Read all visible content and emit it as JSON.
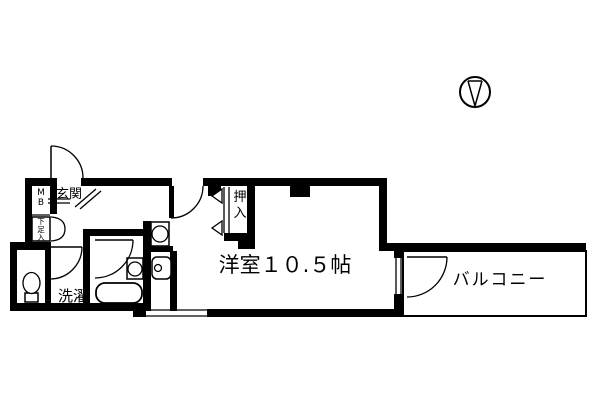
{
  "canvas": {
    "width": 600,
    "height": 400,
    "background": "#ffffff",
    "ink": "#000000"
  },
  "labels": {
    "genkan": "玄関",
    "mb": "MB",
    "shoebox": "下足入",
    "oshiire": "押入",
    "sentaku": "洗濯",
    "room": "洋室１０.５帖",
    "balcony": "バルコニー"
  },
  "plan": {
    "shapes": [
      {
        "t": "wall",
        "n": "wall-top-left",
        "x": 25,
        "y": 178,
        "w": 27,
        "h": 8
      },
      {
        "t": "wall",
        "n": "wall-top-main-a",
        "x": 81,
        "y": 178,
        "w": 91,
        "h": 8
      },
      {
        "t": "wall",
        "n": "wall-top-main-b",
        "x": 203,
        "y": 178,
        "w": 183,
        "h": 8
      },
      {
        "t": "wall",
        "n": "wall-stub-a",
        "x": 208,
        "y": 186,
        "w": 13,
        "h": 10
      },
      {
        "t": "wall",
        "n": "wall-stub-b",
        "x": 290,
        "y": 186,
        "w": 20,
        "h": 11
      },
      {
        "t": "wall",
        "n": "wall-left-upper",
        "x": 25,
        "y": 178,
        "w": 7,
        "h": 64
      },
      {
        "t": "wall",
        "n": "wall-mb-right",
        "x": 50,
        "y": 178,
        "w": 7,
        "h": 36
      },
      {
        "t": "wall",
        "n": "wall-toilet-top",
        "x": 10,
        "y": 242,
        "w": 41,
        "h": 8
      },
      {
        "t": "wall",
        "n": "wall-left-lower",
        "x": 10,
        "y": 242,
        "w": 7,
        "h": 69
      },
      {
        "t": "wall",
        "n": "wall-west-bottom",
        "x": 10,
        "y": 303,
        "w": 136,
        "h": 8
      },
      {
        "t": "wall",
        "n": "wall-toilet-right",
        "x": 45,
        "y": 250,
        "w": 6,
        "h": 53
      },
      {
        "t": "wall",
        "n": "wall-bath-left",
        "x": 83,
        "y": 229,
        "w": 7,
        "h": 74
      },
      {
        "t": "wall",
        "n": "wall-bath-top",
        "x": 83,
        "y": 229,
        "w": 67,
        "h": 7
      },
      {
        "t": "wall",
        "n": "wall-bath-right",
        "x": 143,
        "y": 221,
        "w": 8,
        "h": 90
      },
      {
        "t": "wall",
        "n": "wall-strip-mid",
        "x": 145,
        "y": 246,
        "w": 28,
        "h": 6
      },
      {
        "t": "wall",
        "n": "wall-strip-right",
        "x": 170,
        "y": 251,
        "w": 7,
        "h": 60
      },
      {
        "t": "wall",
        "n": "wall-closet-right",
        "x": 247,
        "y": 178,
        "w": 8,
        "h": 62
      },
      {
        "t": "wall",
        "n": "wall-closet-bottom",
        "x": 224,
        "y": 233,
        "w": 31,
        "h": 8
      },
      {
        "t": "wall",
        "n": "wall-closet-stub",
        "x": 238,
        "y": 241,
        "w": 17,
        "h": 8
      },
      {
        "t": "wall",
        "n": "wall-room-right",
        "x": 379,
        "y": 178,
        "w": 8,
        "h": 73
      },
      {
        "t": "wall",
        "n": "wall-balcony-top",
        "x": 386,
        "y": 243,
        "w": 200,
        "h": 8
      },
      {
        "t": "wall",
        "n": "wall-room-bottom",
        "x": 207,
        "y": 309,
        "w": 200,
        "h": 8
      },
      {
        "t": "wall",
        "n": "wall-room-bottom-left",
        "x": 133,
        "y": 309,
        "w": 13,
        "h": 8
      },
      {
        "t": "wall",
        "n": "wall-window-jamb-top",
        "x": 394,
        "y": 251,
        "w": 9,
        "h": 7
      },
      {
        "t": "wall",
        "n": "wall-window-jamb-bottom",
        "x": 394,
        "y": 294,
        "w": 9,
        "h": 16
      },
      {
        "t": "line",
        "n": "mb-shelf-line",
        "x1": 32,
        "y1": 215,
        "x2": 50,
        "y2": 215
      },
      {
        "t": "line",
        "n": "shoebox-bottom-line",
        "x1": 32,
        "y1": 241,
        "x2": 50,
        "y2": 241
      },
      {
        "t": "line",
        "n": "genkan-step-line-1",
        "x1": 48,
        "y1": 199,
        "x2": 70,
        "y2": 199
      },
      {
        "t": "line",
        "n": "genkan-step-line-2",
        "x1": 48,
        "y1": 203,
        "x2": 70,
        "y2": 203
      },
      {
        "t": "line",
        "n": "genkan-diagonal-1",
        "x1": 75,
        "y1": 207,
        "x2": 96,
        "y2": 189
      },
      {
        "t": "line",
        "n": "genkan-diagonal-2",
        "x1": 80,
        "y1": 209,
        "x2": 101,
        "y2": 191
      },
      {
        "t": "line",
        "n": "closet-front-line-1",
        "x1": 224,
        "y1": 187,
        "x2": 224,
        "y2": 233
      },
      {
        "t": "line",
        "n": "closet-front-line-2",
        "x1": 229,
        "y1": 187,
        "x2": 229,
        "y2": 233
      },
      {
        "t": "line",
        "n": "window-sash-line-1",
        "x1": 396,
        "y1": 257,
        "x2": 396,
        "y2": 294
      },
      {
        "t": "line",
        "n": "window-sash-line-2",
        "x1": 401,
        "y1": 257,
        "x2": 401,
        "y2": 294
      },
      {
        "t": "line",
        "n": "south-window-line-1",
        "x1": 146,
        "y1": 310,
        "x2": 207,
        "y2": 310
      },
      {
        "t": "line",
        "n": "south-window-line-2",
        "x1": 146,
        "y1": 316,
        "x2": 207,
        "y2": 316
      },
      {
        "t": "line",
        "n": "balcony-inner-right",
        "x1": 581,
        "y1": 253,
        "x2": 581,
        "y2": 311
      },
      {
        "t": "line",
        "n": "balcony-inner-bottom",
        "x1": 405,
        "y1": 311,
        "x2": 581,
        "y2": 311
      },
      {
        "t": "box",
        "n": "balcony-outline",
        "x": 403,
        "y": 251,
        "w": 183,
        "h": 65,
        "sw": 2
      },
      {
        "t": "box",
        "n": "shoebox-cabinet",
        "x": 32,
        "y": 217,
        "w": 18,
        "h": 24,
        "sw": 1.5
      },
      {
        "t": "box",
        "n": "stove-icon",
        "x": 151,
        "y": 222,
        "w": 18,
        "h": 24,
        "sw": 1.5
      },
      {
        "t": "circle",
        "n": "stove-burner-icon",
        "cx": 160,
        "cy": 234,
        "r": 8
      },
      {
        "t": "box",
        "n": "washbasin-icon",
        "x": 152,
        "y": 257,
        "w": 19,
        "h": 22,
        "rx": 5,
        "sw": 1.5
      },
      {
        "t": "circle",
        "n": "washbasin-drain-icon",
        "cx": 158,
        "cy": 268,
        "r": 3.5
      },
      {
        "t": "box",
        "n": "bath-sink-icon",
        "x": 127,
        "y": 258,
        "w": 16,
        "h": 21,
        "sw": 1.5
      },
      {
        "t": "circle",
        "n": "bath-sink-bowl-icon",
        "cx": 135,
        "cy": 269,
        "r": 7
      },
      {
        "t": "box",
        "n": "bathtub-icon",
        "x": 96,
        "y": 283,
        "w": 46,
        "h": 20,
        "rx": 9,
        "sw": 1.8
      },
      {
        "t": "box",
        "n": "toilet-tank-icon",
        "x": 25,
        "y": 293,
        "w": 13,
        "h": 9,
        "sw": 1.5
      },
      {
        "t": "ellipse",
        "n": "toilet-bowl-icon",
        "cx": 31.5,
        "cy": 283,
        "rx": 8.5,
        "ry": 10.5
      },
      {
        "t": "path",
        "n": "entrance-door-leaf",
        "d": "M51,146 L51,178",
        "sw": 1.5
      },
      {
        "t": "path",
        "n": "entrance-door-arc",
        "d": "M51,146 A32,32 0 0 1 83,178",
        "sw": 1.3
      },
      {
        "t": "path",
        "n": "washroom-door-leaf",
        "d": "M50,247 L82,247",
        "sw": 1.5
      },
      {
        "t": "path",
        "n": "washroom-door-arc",
        "d": "M82,247 A32,32 0 0 1 50,279",
        "sw": 1.3
      },
      {
        "t": "path",
        "n": "bath-door-leaf",
        "d": "M95,240 L133,240",
        "sw": 1.5
      },
      {
        "t": "path",
        "n": "bath-door-arc",
        "d": "M133,240 A38,38 0 0 1 95,278",
        "sw": 1.3
      },
      {
        "t": "wall",
        "n": "room-door-leaf",
        "x": 169,
        "y": 186,
        "w": 5,
        "h": 32
      },
      {
        "t": "path",
        "n": "room-door-arc",
        "d": "M171,218 A32,32 0 0 0 203,186",
        "sw": 1.3
      },
      {
        "t": "path",
        "n": "balcony-door-leaf",
        "d": "M407,257 L447,257",
        "sw": 1.5
      },
      {
        "t": "path",
        "n": "balcony-door-arc",
        "d": "M447,257 A40,40 0 0 1 407,297",
        "sw": 1.3
      },
      {
        "t": "path",
        "n": "shoebox-door-arc-1",
        "d": "M51,217 Q65,218 65,229",
        "sw": 1.3
      },
      {
        "t": "path",
        "n": "shoebox-door-arc-2",
        "d": "M51,241 Q65,240 65,229",
        "sw": 1.3
      },
      {
        "t": "poly",
        "n": "closet-arrow-icon-1",
        "pts": "212,196 222,189 222,203"
      },
      {
        "t": "poly",
        "n": "closet-arrow-icon-2",
        "pts": "212,228 222,221 222,235"
      },
      {
        "t": "circle",
        "n": "compass-icon",
        "cx": 475,
        "cy": 92,
        "r": 15,
        "sw": 2
      },
      {
        "t": "path",
        "n": "compass-needle-icon",
        "d": "M468,81 L475,106 L482,81 M468,81 L482,81",
        "sw": 1.5
      },
      {
        "t": "text",
        "n": "label-genkan",
        "bind": "labels.genkan",
        "x": 56,
        "y": 198,
        "size": 13
      },
      {
        "t": "text",
        "n": "label-mb",
        "bind": "labels.mb",
        "x": 41,
        "y": 195,
        "size": 9,
        "vert": true,
        "dy": 10
      },
      {
        "t": "text",
        "n": "label-shoebox",
        "bind": "labels.shoebox",
        "x": 41,
        "y": 224,
        "size": 7.5,
        "vert": true,
        "dy": 8
      },
      {
        "t": "text",
        "n": "label-oshiire",
        "bind": "labels.oshiire",
        "x": 240,
        "y": 201,
        "size": 13,
        "vert": true,
        "dy": 16
      },
      {
        "t": "text",
        "n": "label-sentaku",
        "bind": "labels.sentaku",
        "x": 58,
        "y": 301,
        "size": 15
      },
      {
        "t": "text",
        "n": "label-room",
        "bind": "labels.room",
        "x": 285,
        "y": 272,
        "size": 21,
        "anchor": "middle"
      },
      {
        "t": "text",
        "n": "label-balcony",
        "bind": "labels.balcony",
        "x": 500,
        "y": 285,
        "size": 17,
        "anchor": "middle",
        "ls": 2
      }
    ]
  }
}
